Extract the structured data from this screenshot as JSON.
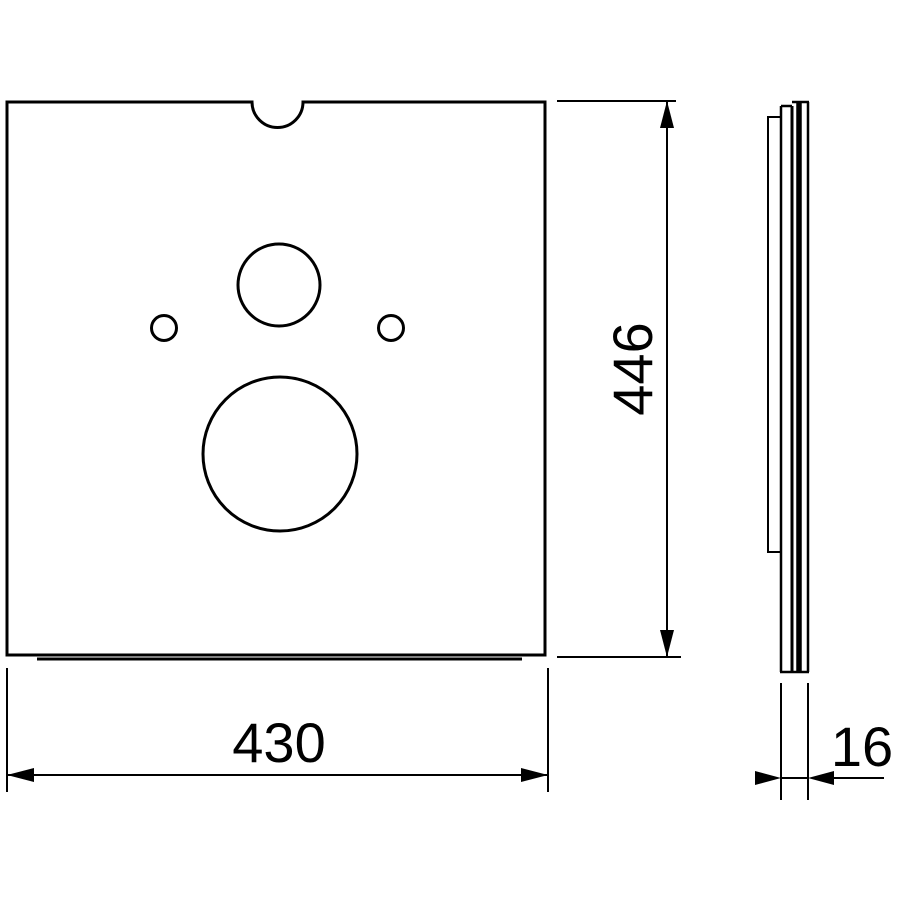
{
  "drawing": {
    "type": "technical-dimension-drawing",
    "subject": "mounting plate with holes, front and side view",
    "background_color": "#ffffff",
    "line_color": "#000000",
    "dimensions": {
      "height_label": "446",
      "width_label": "430",
      "thickness_label": "16"
    },
    "front_view": {
      "features": [
        "top-center semicircular notch",
        "medium circular hole upper center",
        "small circular hole left",
        "small circular hole right",
        "large circular hole lower center"
      ]
    },
    "side_view": {
      "features": [
        "thin layered panel profile",
        "shorter backing layer with step at bottom",
        "dark inner layer"
      ]
    }
  }
}
